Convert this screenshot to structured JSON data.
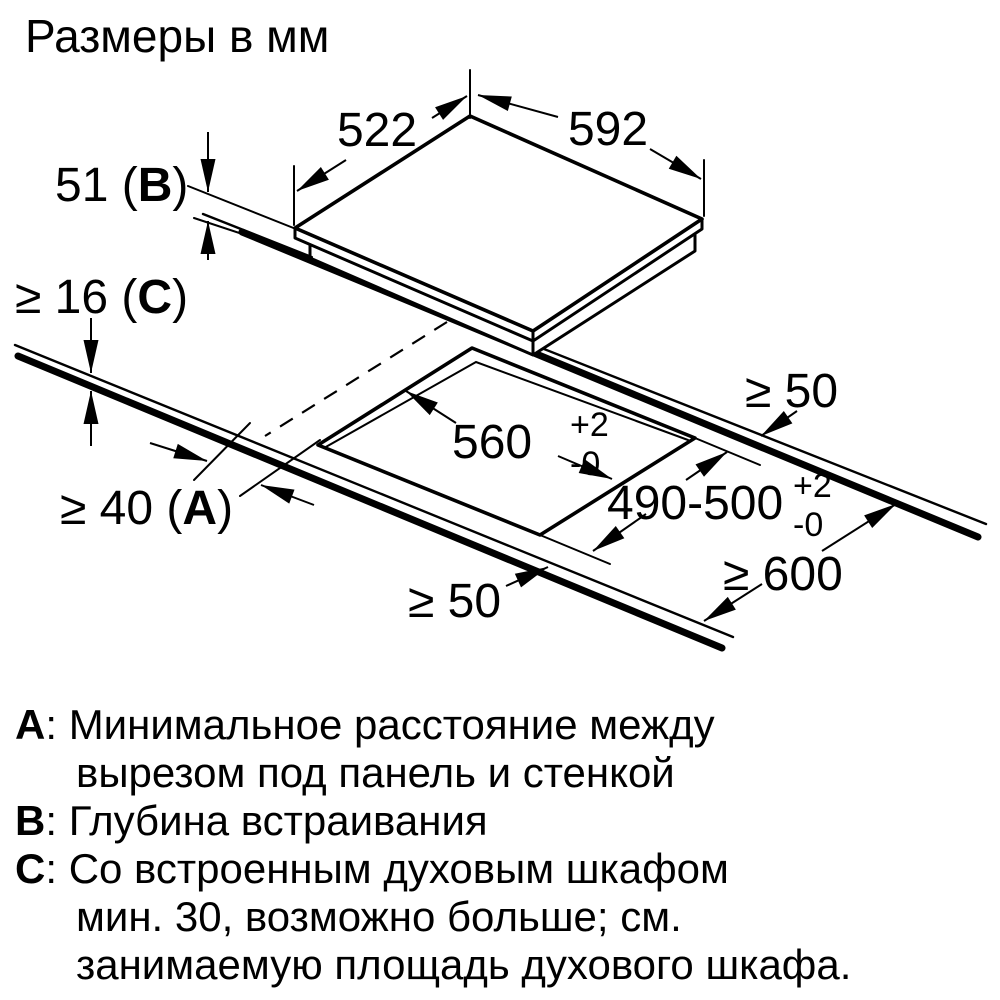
{
  "title": "Размеры в мм",
  "colors": {
    "ink": "#000000",
    "background": "#ffffff"
  },
  "dims": {
    "panel_left": "522",
    "panel_right": "592",
    "panel_thickness": {
      "prefix": "51 (",
      "letter": "B",
      "suffix": ")"
    },
    "worktop_thickness": {
      "prefix": "≥ 16 (",
      "letter": "C",
      "suffix": ")"
    },
    "side_clearance": {
      "prefix": "≥ 40 (",
      "letter": "A",
      "suffix": ")"
    },
    "cutout_width": {
      "value": "560",
      "tol_plus": "+2",
      "tol_minus": "-0"
    },
    "cutout_depth": {
      "value": "490-500",
      "tol_plus": "+2",
      "tol_minus": "-0"
    },
    "back_clearance": "≥ 50",
    "front_clearance": "≥ 50",
    "worktop_depth": "≥ 600"
  },
  "legend": {
    "items": [
      {
        "letter": "А",
        "sep": ": ",
        "lines": [
          "Минимальное расстояние между",
          "вырезом под панель и стенкой"
        ]
      },
      {
        "letter": "B",
        "sep": ": ",
        "lines": [
          "Глубина встраивания"
        ]
      },
      {
        "letter": "C",
        "sep": ": ",
        "lines": [
          "Со встроенным духовым шкафом",
          "мин. 30, возможно больше; см.",
          "занимаемую площадь духового шкафа."
        ]
      }
    ]
  }
}
